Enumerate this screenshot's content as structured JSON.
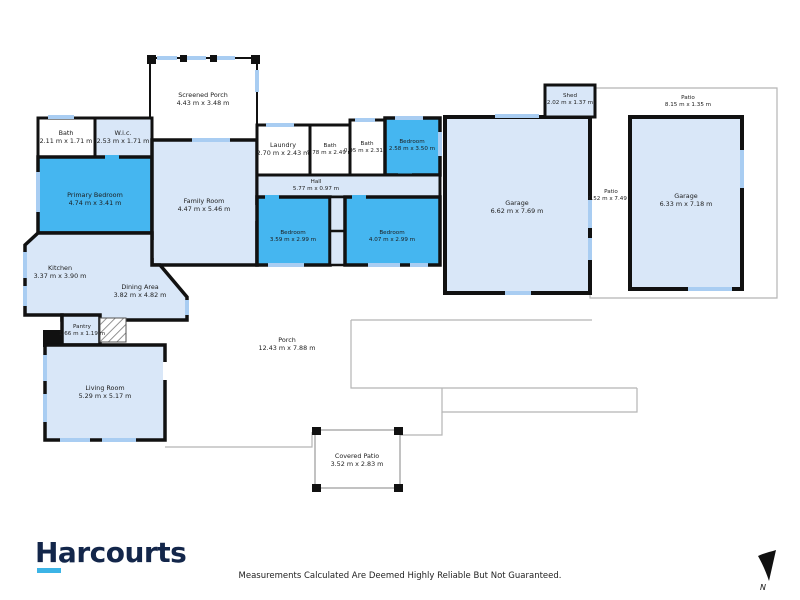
{
  "plan": {
    "rooms": [
      {
        "name": "Screened Porch",
        "dims": "4.43 m x 3.48 m"
      },
      {
        "name": "Bath",
        "dims": "2.11 m x 1.71 m"
      },
      {
        "name": "W.i.c.",
        "dims": "2.53 m x 1.71 m"
      },
      {
        "name": "Primary Bedroom",
        "dims": "4.74 m x 3.41 m"
      },
      {
        "name": "Family Room",
        "dims": "4.47 m x 5.46 m"
      },
      {
        "name": "Laundry",
        "dims": "2.70 m x 2.43 m"
      },
      {
        "name": "Bath",
        "dims": "1.78 m x 2.49 m"
      },
      {
        "name": "Bath",
        "dims": "0.95 m x 2.31 m"
      },
      {
        "name": "Bedroom",
        "dims": "2.58 m x 3.50 m"
      },
      {
        "name": "Hall",
        "dims": "5.77 m x 0.97 m"
      },
      {
        "name": "Bedroom",
        "dims": "3.59 m x 2.99 m"
      },
      {
        "name": "Bedroom",
        "dims": "4.07 m x 2.99 m"
      },
      {
        "name": "Kitchen",
        "dims": "3.37 m x 3.90 m"
      },
      {
        "name": "Dining Area",
        "dims": "3.82 m x 4.82 m"
      },
      {
        "name": "Pantry",
        "dims": "1.66 m x 1.19 m"
      },
      {
        "name": "Living Room",
        "dims": "5.29 m x 5.17 m"
      },
      {
        "name": "Porch",
        "dims": "12.43 m x 7.88 m"
      },
      {
        "name": "Covered Patio",
        "dims": "3.52 m x 2.83 m"
      },
      {
        "name": "Garage",
        "dims": "6.62 m x 7.69 m"
      },
      {
        "name": "Shed",
        "dims": "2.02 m x 1.37 m"
      },
      {
        "name": "Patio",
        "dims": "1.52 m x 7.49 m"
      },
      {
        "name": "Garage",
        "dims": "6.33 m x 7.18 m"
      },
      {
        "name": "Patio",
        "dims": "8.15 m x 1.35 m"
      }
    ],
    "compass": {
      "label": "N"
    }
  },
  "footer": {
    "brand": "Harcourts",
    "disclaimer": "Measurements Calculated Are Deemed Highly Reliable But Not Guaranteed."
  },
  "colors": {
    "bedroom_blue": "#45b6f0",
    "room_light_blue": "#d9e7f8",
    "window_blue": "#a9cdf2",
    "wall_black": "#111111",
    "outline_gray": "#b5b5b5",
    "brand_navy": "#13264a",
    "brand_cyan": "#3cb4e6"
  }
}
